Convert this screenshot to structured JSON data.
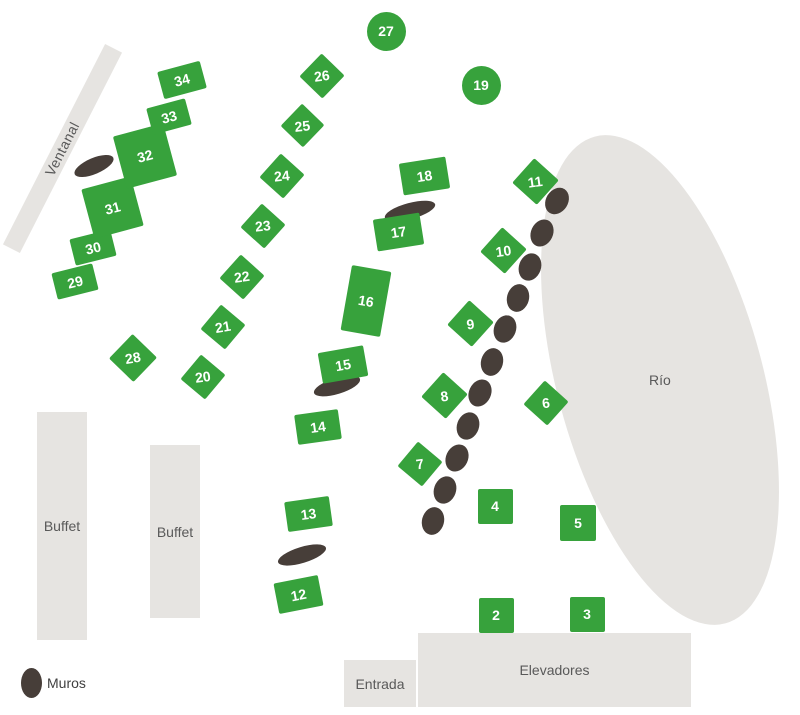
{
  "colors": {
    "table": "#37a23c",
    "table_text": "#ffffff",
    "muro": "#473e39",
    "area": "#e6e4e1",
    "area_text": "#595959"
  },
  "areas": {
    "ventanal": "Ventanal",
    "rio": "Río",
    "buffet_left": "Buffet",
    "buffet_center": "Buffet",
    "entrada": "Entrada",
    "elevadores": "Elevadores"
  },
  "legend": {
    "muros": "Muros"
  },
  "tables": [
    {
      "label": "2",
      "shape": "square",
      "x": 496,
      "y": 615,
      "w": 35,
      "h": 35,
      "rot": 0,
      "trot": 0
    },
    {
      "label": "3",
      "shape": "square",
      "x": 587,
      "y": 614,
      "w": 35,
      "h": 35,
      "rot": 0,
      "trot": 0
    },
    {
      "label": "4",
      "shape": "square",
      "x": 495,
      "y": 506,
      "w": 35,
      "h": 35,
      "rot": 0,
      "trot": 0
    },
    {
      "label": "5",
      "shape": "square",
      "x": 578,
      "y": 523,
      "w": 36,
      "h": 36,
      "rot": 0,
      "trot": 0
    },
    {
      "label": "6",
      "shape": "diamond",
      "x": 546,
      "y": 403,
      "w": 32,
      "h": 32,
      "rot": 42,
      "trot": -8
    },
    {
      "label": "7",
      "shape": "diamond",
      "x": 420,
      "y": 464,
      "w": 32,
      "h": 32,
      "rot": 40,
      "trot": -8
    },
    {
      "label": "8",
      "shape": "diamond",
      "x": 444,
      "y": 395,
      "w": 33,
      "h": 33,
      "rot": 42,
      "trot": -8
    },
    {
      "label": "9",
      "shape": "diamond",
      "x": 470,
      "y": 323,
      "w": 33,
      "h": 33,
      "rot": 42,
      "trot": -8
    },
    {
      "label": "10",
      "shape": "diamond",
      "x": 503,
      "y": 250,
      "w": 33,
      "h": 33,
      "rot": 42,
      "trot": -8
    },
    {
      "label": "11",
      "shape": "diamond",
      "x": 535,
      "y": 181,
      "w": 33,
      "h": 33,
      "rot": 42,
      "trot": -8
    },
    {
      "label": "12",
      "shape": "rect",
      "x": 298,
      "y": 594,
      "w": 45,
      "h": 31,
      "rot": -11,
      "trot": -11
    },
    {
      "label": "13",
      "shape": "rect",
      "x": 308,
      "y": 514,
      "w": 45,
      "h": 30,
      "rot": -8,
      "trot": -8
    },
    {
      "label": "14",
      "shape": "rect",
      "x": 318,
      "y": 427,
      "w": 44,
      "h": 30,
      "rot": -8,
      "trot": -8
    },
    {
      "label": "15",
      "shape": "rect",
      "x": 343,
      "y": 364,
      "w": 46,
      "h": 31,
      "rot": -10,
      "trot": -10
    },
    {
      "label": "16",
      "shape": "rect",
      "x": 366,
      "y": 301,
      "w": 40,
      "h": 66,
      "rot": 10,
      "trot": 10
    },
    {
      "label": "17",
      "shape": "rect",
      "x": 398,
      "y": 232,
      "w": 47,
      "h": 32,
      "rot": -9,
      "trot": -9
    },
    {
      "label": "18",
      "shape": "rect",
      "x": 424,
      "y": 176,
      "w": 47,
      "h": 32,
      "rot": -9,
      "trot": -9
    },
    {
      "label": "19",
      "shape": "circle",
      "x": 481,
      "y": 85,
      "w": 39,
      "h": 39,
      "rot": 0,
      "trot": 0
    },
    {
      "label": "20",
      "shape": "diamond",
      "x": 203,
      "y": 377,
      "w": 32,
      "h": 32,
      "rot": 40,
      "trot": -8
    },
    {
      "label": "21",
      "shape": "diamond",
      "x": 223,
      "y": 327,
      "w": 32,
      "h": 32,
      "rot": 40,
      "trot": -10
    },
    {
      "label": "22",
      "shape": "diamond",
      "x": 242,
      "y": 277,
      "w": 32,
      "h": 32,
      "rot": 42,
      "trot": -8
    },
    {
      "label": "23",
      "shape": "diamond",
      "x": 263,
      "y": 226,
      "w": 32,
      "h": 32,
      "rot": 42,
      "trot": -6
    },
    {
      "label": "24",
      "shape": "diamond",
      "x": 282,
      "y": 176,
      "w": 32,
      "h": 32,
      "rot": 42,
      "trot": -6
    },
    {
      "label": "25",
      "shape": "diamond",
      "x": 302,
      "y": 125,
      "w": 31,
      "h": 31,
      "rot": 44,
      "trot": -6
    },
    {
      "label": "26",
      "shape": "diamond",
      "x": 322,
      "y": 76,
      "w": 32,
      "h": 32,
      "rot": 44,
      "trot": -8
    },
    {
      "label": "27",
      "shape": "circle",
      "x": 386,
      "y": 31,
      "w": 39,
      "h": 39,
      "rot": 0,
      "trot": 0
    },
    {
      "label": "28",
      "shape": "diamond",
      "x": 133,
      "y": 358,
      "w": 34,
      "h": 34,
      "rot": 44,
      "trot": -10
    },
    {
      "label": "29",
      "shape": "rect",
      "x": 75,
      "y": 281,
      "w": 42,
      "h": 27,
      "rot": -14,
      "trot": -14
    },
    {
      "label": "30",
      "shape": "rect",
      "x": 93,
      "y": 247,
      "w": 42,
      "h": 27,
      "rot": -14,
      "trot": -14
    },
    {
      "label": "31",
      "shape": "rect",
      "x": 112,
      "y": 207,
      "w": 51,
      "h": 51,
      "rot": -15,
      "trot": -15
    },
    {
      "label": "32",
      "shape": "rect",
      "x": 145,
      "y": 156,
      "w": 52,
      "h": 54,
      "rot": -15,
      "trot": -15
    },
    {
      "label": "33",
      "shape": "rect",
      "x": 169,
      "y": 116,
      "w": 40,
      "h": 27,
      "rot": -15,
      "trot": -15
    },
    {
      "label": "34",
      "shape": "rect",
      "x": 182,
      "y": 80,
      "w": 44,
      "h": 28,
      "rot": -15,
      "trot": -15
    }
  ],
  "muros": [
    {
      "x": 94,
      "y": 166,
      "rx": 21,
      "ry": 8,
      "rot": -23
    },
    {
      "x": 410,
      "y": 211,
      "rx": 26,
      "ry": 8,
      "rot": -15
    },
    {
      "x": 337,
      "y": 386,
      "rx": 24,
      "ry": 8,
      "rot": -17
    },
    {
      "x": 302,
      "y": 555,
      "rx": 25,
      "ry": 8,
      "rot": -17
    },
    {
      "x": 557,
      "y": 201,
      "rx": 11,
      "ry": 14,
      "rot": 32
    },
    {
      "x": 542,
      "y": 233,
      "rx": 11,
      "ry": 14,
      "rot": 25
    },
    {
      "x": 530,
      "y": 267,
      "rx": 11,
      "ry": 14,
      "rot": 20
    },
    {
      "x": 518,
      "y": 298,
      "rx": 11,
      "ry": 14,
      "rot": 15
    },
    {
      "x": 505,
      "y": 329,
      "rx": 11,
      "ry": 14,
      "rot": 20
    },
    {
      "x": 492,
      "y": 362,
      "rx": 11,
      "ry": 14,
      "rot": 15
    },
    {
      "x": 480,
      "y": 393,
      "rx": 11,
      "ry": 14,
      "rot": 25
    },
    {
      "x": 468,
      "y": 426,
      "rx": 11,
      "ry": 14,
      "rot": 20
    },
    {
      "x": 457,
      "y": 458,
      "rx": 11,
      "ry": 14,
      "rot": 25
    },
    {
      "x": 445,
      "y": 490,
      "rx": 11,
      "ry": 14,
      "rot": 20
    },
    {
      "x": 433,
      "y": 521,
      "rx": 11,
      "ry": 14,
      "rot": 15
    }
  ]
}
